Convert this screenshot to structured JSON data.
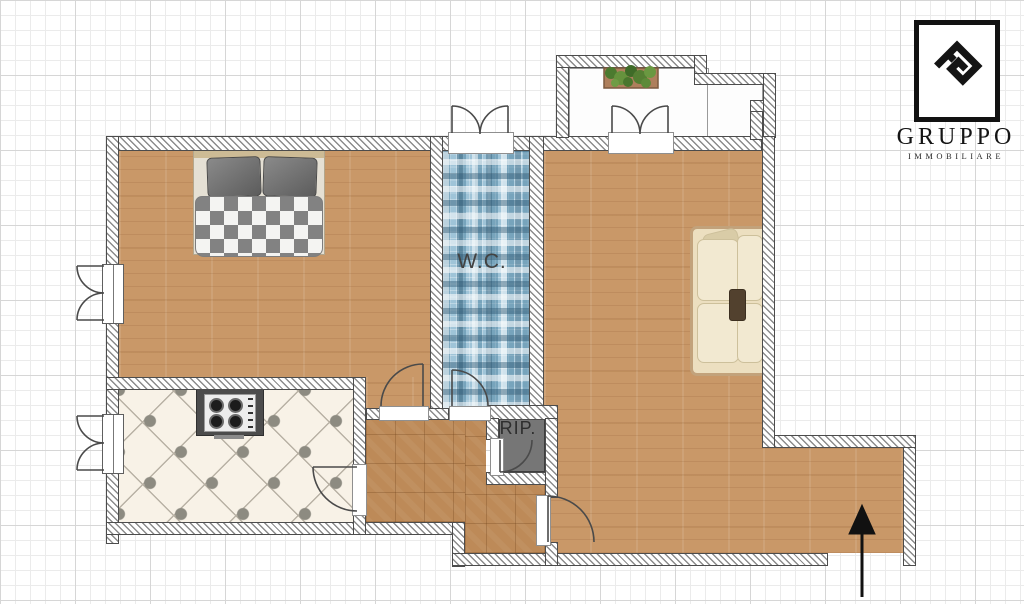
{
  "floor_plan": {
    "labels": {
      "wc": "W.C.",
      "storage": "RIP."
    },
    "rooms": [
      "bedroom",
      "wc",
      "living-room",
      "kitchen",
      "hall",
      "storage",
      "balcony"
    ],
    "colors": {
      "wood_floor": "#c99868",
      "parquet_floor": "#bd8a58",
      "kitchen_tile": "#f8f2e7",
      "wc_mosaic": "#9fc4d8",
      "storage_floor": "#767676",
      "wall_outline": "#4c4c4c",
      "sofa": "#ecdfc0",
      "counter": "#4c4c4c",
      "plant_green": "#557f33",
      "arrow": "#111111"
    },
    "entrance_arrow_direction": "up"
  },
  "logo": {
    "brand": "GRUPPO",
    "subtitle": "IMMOBILIARE"
  }
}
